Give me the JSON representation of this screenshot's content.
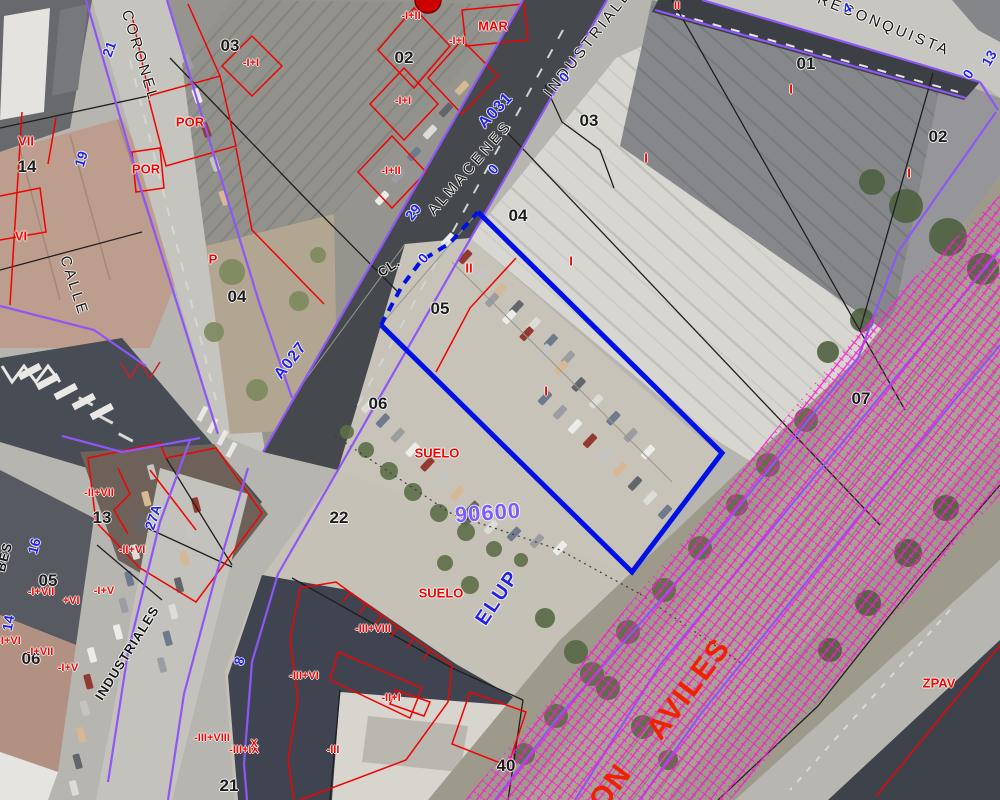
{
  "view": {
    "description": "Aerial cadastral map with parcel overlay",
    "width": 1000,
    "height": 800
  },
  "legend_colors": {
    "cadastral_parcel_line": "#ee0400",
    "urban_boundary_line": "#8d57f7",
    "selected_parcel_outline": "#0011e8",
    "railway_zone_hatch": "#ff17cd",
    "street_label": "#151515",
    "portal_number": "#2222e6",
    "parcel_code": "#7d5cfc"
  },
  "labels": [
    {
      "t": "03",
      "x": 230,
      "y": 46,
      "r": 0,
      "c": "num",
      "n": "parcel-number"
    },
    {
      "t": "02",
      "x": 404,
      "y": 58,
      "r": 0,
      "c": "num",
      "n": "parcel-number"
    },
    {
      "t": "01",
      "x": 806,
      "y": 64,
      "r": 0,
      "c": "num",
      "n": "parcel-number"
    },
    {
      "t": "03",
      "x": 589,
      "y": 121,
      "r": 0,
      "c": "num",
      "n": "parcel-number"
    },
    {
      "t": "02",
      "x": 938,
      "y": 137,
      "r": 0,
      "c": "num",
      "n": "parcel-number"
    },
    {
      "t": "14",
      "x": 27,
      "y": 167,
      "r": 0,
      "c": "num",
      "n": "parcel-number"
    },
    {
      "t": "04",
      "x": 518,
      "y": 216,
      "r": 0,
      "c": "num",
      "n": "parcel-number"
    },
    {
      "t": "04",
      "x": 237,
      "y": 297,
      "r": 0,
      "c": "num",
      "n": "parcel-number"
    },
    {
      "t": "05",
      "x": 440,
      "y": 309,
      "r": 0,
      "c": "num",
      "n": "parcel-number"
    },
    {
      "t": "06",
      "x": 378,
      "y": 404,
      "r": 0,
      "c": "num",
      "n": "parcel-number"
    },
    {
      "t": "07",
      "x": 861,
      "y": 399,
      "r": 0,
      "c": "num",
      "n": "parcel-number"
    },
    {
      "t": "13",
      "x": 102,
      "y": 518,
      "r": 0,
      "c": "num",
      "n": "parcel-number"
    },
    {
      "t": "22",
      "x": 339,
      "y": 518,
      "r": 0,
      "c": "num",
      "n": "parcel-number"
    },
    {
      "t": "05",
      "x": 48,
      "y": 581,
      "r": 0,
      "c": "num",
      "n": "parcel-number"
    },
    {
      "t": "06",
      "x": 31,
      "y": 659,
      "r": 0,
      "c": "num",
      "n": "parcel-number"
    },
    {
      "t": "21",
      "x": 229,
      "y": 786,
      "r": 0,
      "c": "num",
      "n": "parcel-number"
    },
    {
      "t": "40",
      "x": 506,
      "y": 766,
      "r": 0,
      "c": "num",
      "n": "parcel-number"
    },
    {
      "t": "CORONEL",
      "x": 140,
      "y": 56,
      "r": 73,
      "c": "street",
      "n": "street-name"
    },
    {
      "t": "CALLE",
      "x": 74,
      "y": 286,
      "r": 72,
      "c": "street",
      "n": "street-name"
    },
    {
      "t": "ALMACENES",
      "x": 470,
      "y": 168,
      "r": -49,
      "c": "street",
      "n": "street-name"
    },
    {
      "t": "INDUSTRIALES",
      "x": 592,
      "y": 38,
      "r": -52,
      "c": "street",
      "n": "street-name"
    },
    {
      "t": "RECONQUISTA",
      "x": 884,
      "y": 25,
      "r": 22,
      "c": "street",
      "n": "street-name"
    },
    {
      "t": "INDUSTRIALES",
      "x": 127,
      "y": 653,
      "r": -58,
      "c": "streetsm",
      "n": "street-name"
    },
    {
      "t": "BES",
      "x": 4,
      "y": 557,
      "r": -75,
      "c": "streetsm",
      "n": "street-name"
    },
    {
      "t": "CL.",
      "x": 389,
      "y": 267,
      "r": -33,
      "c": "streetsm",
      "n": "street-type-label"
    },
    {
      "t": "21",
      "x": 109,
      "y": 49,
      "r": -70,
      "c": "blue",
      "n": "portal-number"
    },
    {
      "t": "19",
      "x": 81,
      "y": 159,
      "r": -73,
      "c": "blue",
      "n": "portal-number"
    },
    {
      "t": "29",
      "x": 413,
      "y": 212,
      "r": -52,
      "c": "blue",
      "n": "portal-number"
    },
    {
      "t": "A031",
      "x": 496,
      "y": 111,
      "r": -47,
      "c": "bluecode",
      "n": "street-code"
    },
    {
      "t": "A027",
      "x": 291,
      "y": 361,
      "r": -52,
      "c": "bluecode",
      "n": "street-code"
    },
    {
      "t": "0",
      "x": 564,
      "y": 77,
      "r": -50,
      "c": "blue",
      "n": "portal-number"
    },
    {
      "t": "0",
      "x": 493,
      "y": 169,
      "r": -50,
      "c": "blue",
      "n": "portal-number"
    },
    {
      "t": "0",
      "x": 423,
      "y": 258,
      "r": -50,
      "c": "blue",
      "n": "portal-number"
    },
    {
      "t": "0",
      "x": 968,
      "y": 74,
      "r": -55,
      "c": "blue",
      "n": "portal-number"
    },
    {
      "t": "4",
      "x": 847,
      "y": 8,
      "r": -28,
      "c": "blue",
      "n": "portal-number"
    },
    {
      "t": "13",
      "x": 989,
      "y": 58,
      "r": -60,
      "c": "blue",
      "n": "portal-number"
    },
    {
      "t": "16",
      "x": 34,
      "y": 546,
      "r": -75,
      "c": "blue",
      "n": "portal-number"
    },
    {
      "t": "14",
      "x": 8,
      "y": 623,
      "r": -80,
      "c": "blue",
      "n": "portal-number"
    },
    {
      "t": "27A",
      "x": 153,
      "y": 517,
      "r": -72,
      "c": "blue",
      "n": "portal-number"
    },
    {
      "t": "8",
      "x": 239,
      "y": 661,
      "r": -75,
      "c": "blue",
      "n": "portal-number"
    },
    {
      "t": "ELUP",
      "x": 498,
      "y": 598,
      "r": -56,
      "c": "bluebig",
      "n": "zone-label"
    },
    {
      "t": "90600",
      "x": 488,
      "y": 513,
      "r": -4,
      "c": "vcode",
      "n": "parcel-code"
    },
    {
      "t": "-I+II",
      "x": 411,
      "y": 16,
      "r": 0,
      "c": "red",
      "n": "construction-label"
    },
    {
      "t": "MAR",
      "x": 493,
      "y": 26,
      "r": 0,
      "c": "redmd",
      "n": "zone-label"
    },
    {
      "t": "-I+I",
      "x": 457,
      "y": 41,
      "r": 0,
      "c": "red",
      "n": "construction-label"
    },
    {
      "t": "-I+I",
      "x": 251,
      "y": 63,
      "r": 0,
      "c": "red",
      "n": "construction-label"
    },
    {
      "t": "POR",
      "x": 190,
      "y": 122,
      "r": 0,
      "c": "redmd",
      "n": "construction-label"
    },
    {
      "t": "POR",
      "x": 146,
      "y": 169,
      "r": 0,
      "c": "redmd",
      "n": "construction-label"
    },
    {
      "t": "-I+I",
      "x": 403,
      "y": 101,
      "r": 0,
      "c": "red",
      "n": "construction-label"
    },
    {
      "t": "-I+II",
      "x": 391,
      "y": 171,
      "r": 0,
      "c": "red",
      "n": "construction-label"
    },
    {
      "t": "P",
      "x": 213,
      "y": 259,
      "r": 0,
      "c": "redmd",
      "n": "construction-label"
    },
    {
      "t": "II",
      "x": 469,
      "y": 268,
      "r": 0,
      "c": "redmd",
      "n": "construction-label"
    },
    {
      "t": "I",
      "x": 571,
      "y": 261,
      "r": 0,
      "c": "redmd",
      "n": "construction-label"
    },
    {
      "t": "I",
      "x": 546,
      "y": 391,
      "r": 0,
      "c": "redmd",
      "n": "construction-label"
    },
    {
      "t": "I",
      "x": 646,
      "y": 158,
      "r": 0,
      "c": "redmd",
      "n": "construction-label"
    },
    {
      "t": "I",
      "x": 791,
      "y": 89,
      "r": 0,
      "c": "redmd",
      "n": "construction-label"
    },
    {
      "t": "I",
      "x": 909,
      "y": 173,
      "r": 0,
      "c": "redmd",
      "n": "construction-label"
    },
    {
      "t": "II",
      "x": 677,
      "y": 6,
      "r": 0,
      "c": "red",
      "n": "construction-label"
    },
    {
      "t": "VII",
      "x": 26,
      "y": 141,
      "r": 0,
      "c": "redmd",
      "n": "construction-label"
    },
    {
      "t": "VI",
      "x": 21,
      "y": 236,
      "r": 0,
      "c": "redmd",
      "n": "construction-label"
    },
    {
      "t": "SUELO",
      "x": 437,
      "y": 453,
      "r": 0,
      "c": "redmd",
      "n": "land-class-label"
    },
    {
      "t": "SUELO",
      "x": 441,
      "y": 593,
      "r": 0,
      "c": "redmd",
      "n": "land-class-label"
    },
    {
      "t": "-II+VII",
      "x": 99,
      "y": 493,
      "r": 0,
      "c": "red",
      "n": "construction-label"
    },
    {
      "t": "-II+VI",
      "x": 132,
      "y": 550,
      "r": 0,
      "c": "red",
      "n": "construction-label"
    },
    {
      "t": "-I+VII",
      "x": 41,
      "y": 592,
      "r": 0,
      "c": "red",
      "n": "construction-label"
    },
    {
      "t": "+VI",
      "x": 71,
      "y": 601,
      "r": 0,
      "c": "red",
      "n": "construction-label"
    },
    {
      "t": "-I+V",
      "x": 104,
      "y": 591,
      "r": 0,
      "c": "red",
      "n": "construction-label"
    },
    {
      "t": "-I+VI",
      "x": 9,
      "y": 641,
      "r": 0,
      "c": "red",
      "n": "construction-label"
    },
    {
      "t": "-I+VII",
      "x": 40,
      "y": 652,
      "r": 0,
      "c": "red",
      "n": "construction-label"
    },
    {
      "t": "-I+V",
      "x": 68,
      "y": 668,
      "r": 0,
      "c": "red",
      "n": "construction-label"
    },
    {
      "t": "-III+VIII",
      "x": 373,
      "y": 629,
      "r": 0,
      "c": "red",
      "n": "construction-label"
    },
    {
      "t": "-III+VI",
      "x": 304,
      "y": 676,
      "r": 0,
      "c": "red",
      "n": "construction-label"
    },
    {
      "t": "-II+I",
      "x": 391,
      "y": 698,
      "r": 0,
      "c": "red",
      "n": "construction-label"
    },
    {
      "t": "-III",
      "x": 333,
      "y": 750,
      "r": 0,
      "c": "red",
      "n": "construction-label"
    },
    {
      "t": "-III+VIII",
      "x": 212,
      "y": 738,
      "r": 0,
      "c": "red",
      "n": "construction-label"
    },
    {
      "t": "-III+IX",
      "x": 244,
      "y": 750,
      "r": 0,
      "c": "red",
      "n": "construction-label"
    },
    {
      "t": "X",
      "x": 254,
      "y": 744,
      "r": 0,
      "c": "red",
      "n": "construction-label"
    },
    {
      "t": "ZPAV",
      "x": 939,
      "y": 683,
      "r": 0,
      "c": "redmd",
      "n": "zone-label"
    },
    {
      "t": "AVILES",
      "x": 689,
      "y": 689,
      "r": -53,
      "c": "redbig",
      "n": "railway-line-label"
    },
    {
      "t": "ON",
      "x": 611,
      "y": 787,
      "r": -53,
      "c": "redbig",
      "n": "railway-line-label"
    }
  ]
}
